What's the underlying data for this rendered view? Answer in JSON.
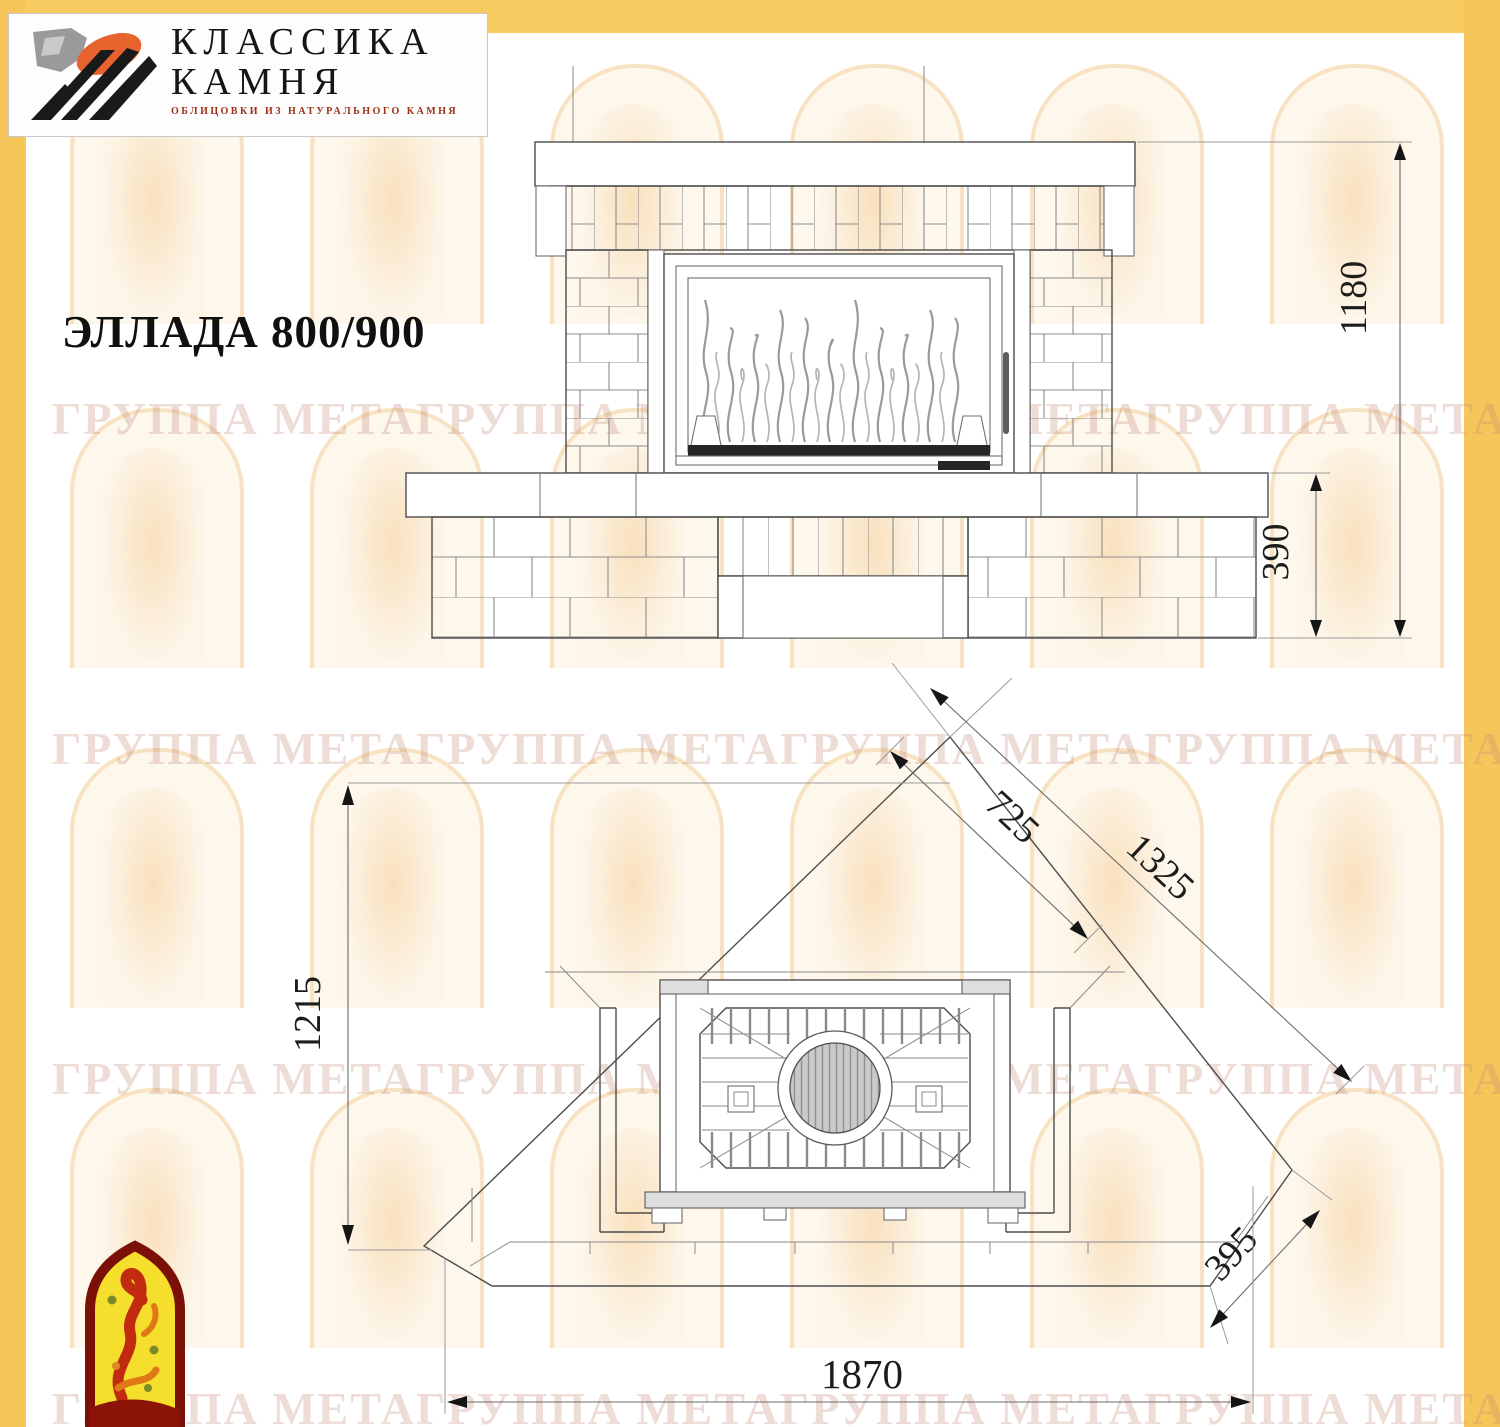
{
  "brand": {
    "name_line1": "КЛАССИКА",
    "name_line2": "КАМНЯ",
    "subtitle": "ОБЛИЦОВКИ ИЗ НАТУРАЛЬНОГО КАМНЯ"
  },
  "title": "ЭЛЛАДА 800/900",
  "watermark": {
    "text": "ГРУППА МЕТАГРУППА МЕТАГРУППА МЕТАГРУППА МЕТАГРУППА МЕТА"
  },
  "drawing": {
    "front_view": {
      "total_height": "1180",
      "base_height": "390"
    },
    "plan_view": {
      "depth": "1215",
      "insert_front": "725",
      "side_length": "1325",
      "chamfer": "395",
      "total_width": "1870"
    }
  },
  "colors": {
    "frame_yellow": "#f6c65a",
    "logo_orange": "#e8622d",
    "logo_black": "#1a1a1a",
    "meta_red": "#c32b10",
    "meta_yellow": "#f5de2c",
    "meta_maroon": "#7a1008"
  }
}
